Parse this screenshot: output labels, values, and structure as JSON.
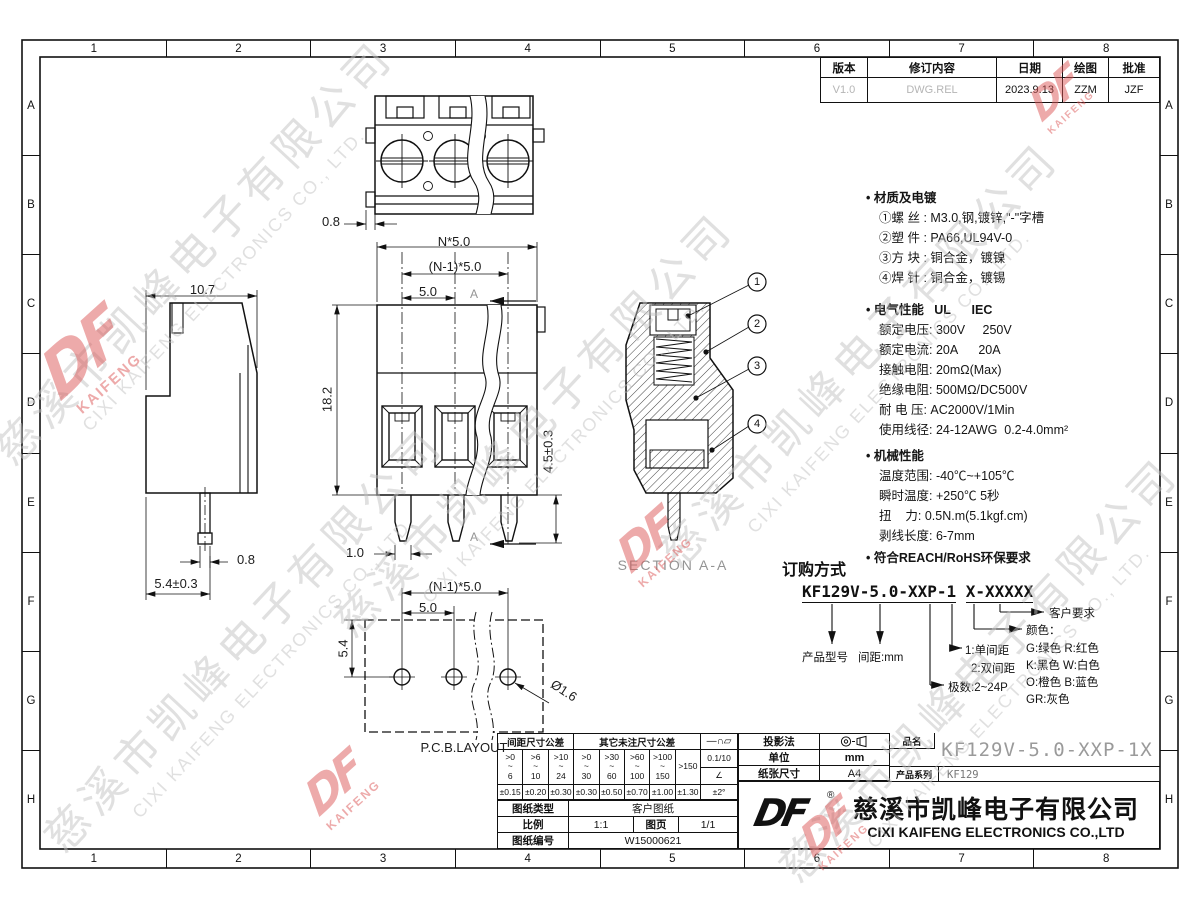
{
  "frame": {
    "columns": [
      "1",
      "2",
      "3",
      "4",
      "5",
      "6",
      "7",
      "8"
    ],
    "rows": [
      "A",
      "B",
      "C",
      "D",
      "E",
      "F",
      "G",
      "H"
    ]
  },
  "revision_table": {
    "headers": [
      "版本",
      "修订内容",
      "日期",
      "绘图",
      "批准"
    ],
    "row": {
      "version": "V1.0",
      "content": "DWG.REL",
      "date": "2023.9.13",
      "drawn": "ZZM",
      "approved": "JZF"
    }
  },
  "dims": {
    "top_view_pin": "0.8",
    "pitch_total": "N*5.0",
    "pitch_span": "(N-1)*5.0",
    "pitch_one": "5.0",
    "front_height": "18.2",
    "pin_length": "4.5±0.3",
    "pin_width_front": "1.0",
    "side_width": "10.7",
    "side_pin": "0.8",
    "side_offset": "5.4±0.3",
    "section_mark": "A",
    "section_label": "SECTION A-A",
    "balloons": [
      "1",
      "2",
      "3",
      "4"
    ],
    "pcb_span": "(N-1)*5.0",
    "pcb_pitch": "5.0",
    "pcb_row": "5.4",
    "pcb_hole": "Ø1.6",
    "pcb_label": "P.C.B.LAYOUT"
  },
  "specs": {
    "material": {
      "title": "• 材质及电镀",
      "items": [
        "①螺 丝 : M3.0,钢,镀锌,\"-\"字槽",
        "②塑 件 : PA66,UL94V-0",
        "③方 块 : 铜合金，镀镍",
        "④焊 针 : 铜合金，镀锡"
      ]
    },
    "electrical": {
      "title": "• 电气性能   UL      IEC",
      "items": [
        "额定电压: 300V     250V",
        "额定电流: 20A      20A",
        "接触电阻: 20mΩ(Max)",
        "绝缘电阻: 500MΩ/DC500V",
        "耐 电 压: AC2000V/1Min",
        "使用线径: 24-12AWG  0.2-4.0mm²"
      ]
    },
    "mechanical": {
      "title": "• 机械性能",
      "items": [
        "温度范围: -40℃~+105℃",
        "瞬时温度: +250℃ 5秒",
        "扭    力: 0.5N.m(5.1kgf.cm)",
        "剥线长度: 6-7mm"
      ]
    },
    "compliance": "• 符合REACH/RoHS环保要求"
  },
  "ordering": {
    "title": "订购方式",
    "code_main": "KF129V-5.0-XXP-1",
    "code_suffix": "X-XXXXX",
    "labels": {
      "product": "产品型号",
      "pitch": "间距:mm",
      "row_type_1": "1:单间距",
      "row_type_2": "2:双间距",
      "poles": "极数:2~24P",
      "color_title": "颜色：",
      "colors": [
        "G:绿色  R:红色",
        "K:黑色  W:白色",
        "O:橙色  B:蓝色",
        "GR:灰色"
      ],
      "customer": "客户要求"
    }
  },
  "tolerance_table": {
    "header_pitch": "间距尺寸公差",
    "header_other": "其它未注尺寸公差",
    "symbols": "—∩▱",
    "flatness": "0.1/10",
    "angle_symbol": "∠",
    "angle_tol": "±2°",
    "ranges": [
      ">0\n~\n6",
      ">6\n~\n10",
      ">10\n~\n24",
      ">0\n~\n30",
      ">30\n~\n60",
      ">60\n~\n100",
      ">100\n~\n150",
      ">150"
    ],
    "tols": [
      "±0.15",
      "±0.20",
      "±0.30",
      "±0.30",
      "±0.50",
      "±0.70",
      "±1.00",
      "±1.30"
    ]
  },
  "title_block": {
    "projection_label": "投影法",
    "unit_label": "单位",
    "unit_value": "mm",
    "paper_label": "纸张尺寸",
    "paper_value": "A4",
    "part_label": "品名",
    "part_value": "KF129V-5.0-XXP-1X",
    "series_label": "产品系列",
    "series_value": "KF129",
    "doc_type_label": "图纸类型",
    "doc_type_value": "客户图纸",
    "scale_label": "比例",
    "scale_value": "1:1",
    "page_label": "图页",
    "page_value": "1/1",
    "doc_no_label": "图纸编号",
    "doc_no_value": "W15000621"
  },
  "company": {
    "logo": "DF",
    "reg": "®",
    "name_cn": "慈溪市凯峰电子有限公司",
    "name_en": "CIXI KAIFENG ELECTRONICS CO.,LTD"
  },
  "watermark": {
    "cn": "慈溪市凯峰电子有限公司",
    "en": "CIXI KAIFENG ELECTRONICS CO., LTD.",
    "logo": "DF",
    "logo_sub": "KAIFENG"
  }
}
